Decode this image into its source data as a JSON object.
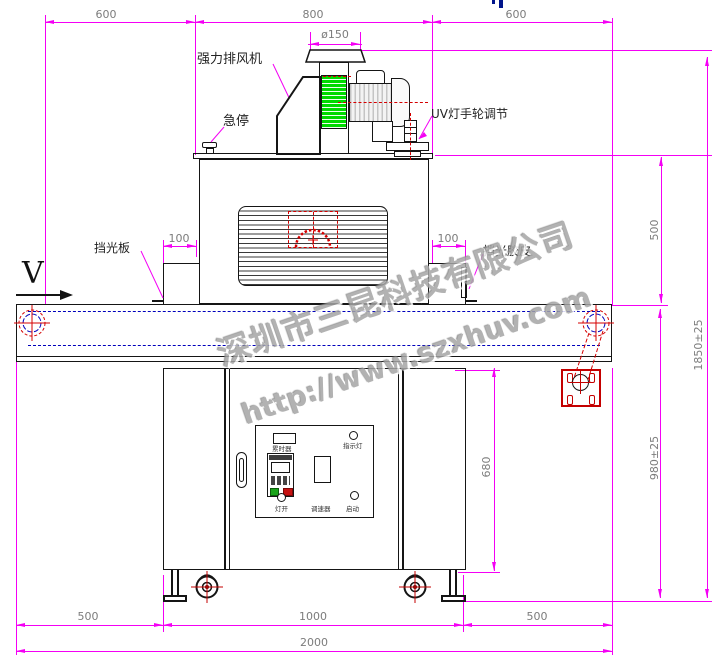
{
  "watermark": {
    "company": "深圳市三昆科技有限公司",
    "url": "http://www.szxhuv.com"
  },
  "labels": {
    "exhaust_fan": "强力排风机",
    "emergency_stop": "急停",
    "uv_handwheel": "UV灯手轮调节",
    "light_baffle": "挡光板",
    "light_rubber": "挡光胶皮",
    "view_direction": "V"
  },
  "panel": {
    "hour_meter": "累时器",
    "indicator_light": "指示灯",
    "lamp_switch": "灯开",
    "speed_controller": "调速器",
    "start_button": "启动"
  },
  "dims": {
    "top_left": "600",
    "top_middle": "800",
    "top_right": "600",
    "duct_diameter": "ø150",
    "baffle_left": "100",
    "baffle_right": "100",
    "lamp_house_height": "500",
    "total_height": "1850±25",
    "belt_height": "980±25",
    "cabinet_height": "680",
    "bottom_left": "500",
    "bottom_middle": "1000",
    "bottom_right": "500",
    "total_length": "2000"
  },
  "colors": {
    "dimension": "#f400f4",
    "centerline": "#d40000",
    "belt_line": "#0000bb",
    "fan_fill": "#00d900",
    "watermark": "#a5a5a5"
  }
}
